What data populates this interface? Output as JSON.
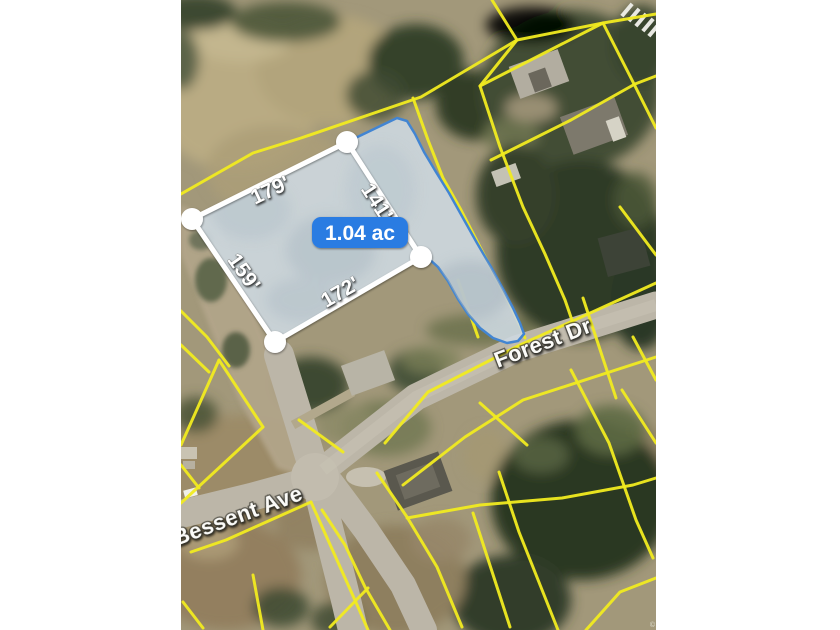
{
  "map": {
    "area_badge": "1.04 ac",
    "measurements": {
      "top_edge": "179'",
      "right_edge": "141'",
      "left_edge": "159'",
      "bottom_edge": "172'"
    },
    "streets": {
      "forest": "Forest Dr",
      "bessent": "Bessent Ave"
    },
    "attribution": "©",
    "colors": {
      "parcel_boundary_lines": "#f1eb20",
      "highlight_outline": "#4285d2",
      "highlight_fill": "#cdd8e0",
      "area_badge_bg": "#2b7be2",
      "measure_overlay": "#ffffff"
    }
  }
}
